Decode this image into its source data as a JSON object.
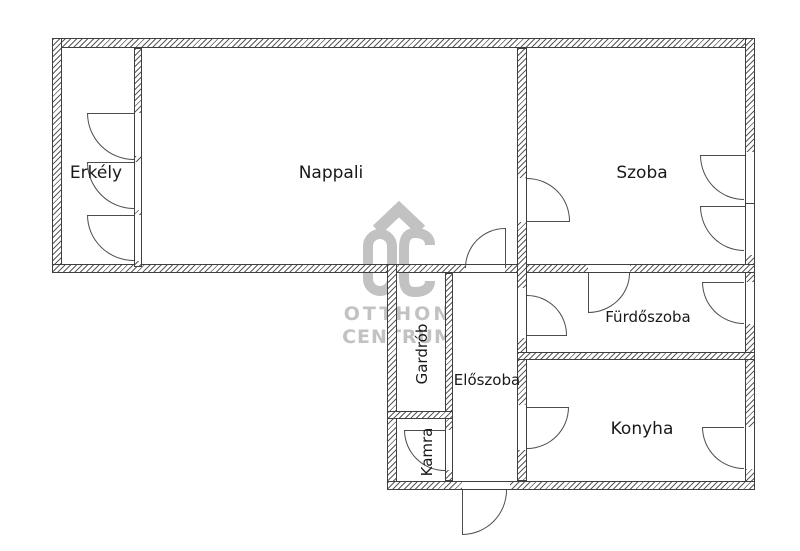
{
  "plan": {
    "type": "apartment-floor-plan",
    "language": "Hungarian"
  },
  "rooms": [
    {
      "id": "erkely",
      "label": "Erkély"
    },
    {
      "id": "nappali",
      "label": "Nappali"
    },
    {
      "id": "szoba",
      "label": "Szoba"
    },
    {
      "id": "furdoszoba",
      "label": "Fürdőszoba"
    },
    {
      "id": "eloszoba",
      "label": "Előszoba"
    },
    {
      "id": "konyha",
      "label": "Konyha"
    },
    {
      "id": "gardrob",
      "label": "Gardrób"
    },
    {
      "id": "kamra",
      "label": "Kamra"
    }
  ],
  "watermark": {
    "logo": "OC",
    "line1": "OTTHON",
    "line2": "CENTRUM"
  },
  "colors": {
    "background": "#ffffff",
    "wall_line": "#3f3f3f",
    "door_line": "#4c4c4c",
    "label_text": "#191919",
    "watermark": "#c2c2c2"
  }
}
